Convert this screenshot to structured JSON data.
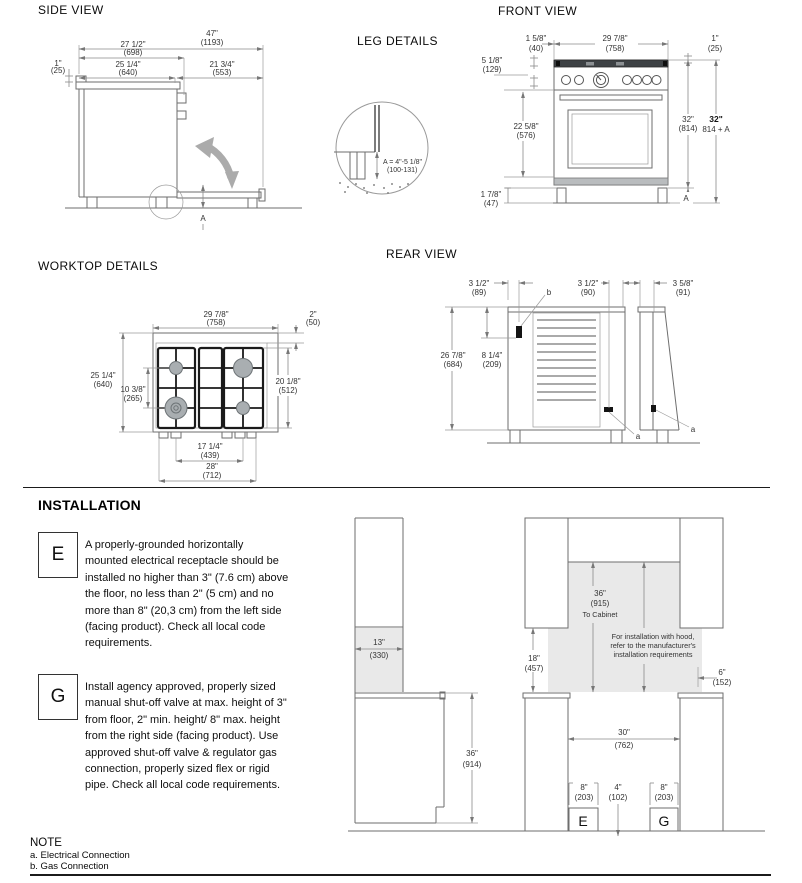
{
  "titles": {
    "side_view": "SIDE VIEW",
    "front_view": "FRONT VIEW",
    "leg_details": "LEG DETAILS",
    "worktop_details": "WORKTOP DETAILS",
    "rear_view": "REAR VIEW",
    "installation": "INSTALLATION"
  },
  "side_view": {
    "dims": {
      "overall_depth_in": "47\"",
      "overall_depth_mm": "(1193)",
      "depth_handle_in": "27 1/2\"",
      "depth_handle_mm": "(698)",
      "top_trim_in": "1\"",
      "top_trim_mm": "(25)",
      "body_depth_in": "25 1/4\"",
      "body_depth_mm": "(640)",
      "door_open_in": "21 3/4\"",
      "door_open_mm": "(553)",
      "leg_label": "A"
    }
  },
  "front_view": {
    "dims": {
      "burner_offset_in": "1 5/8\"",
      "burner_offset_mm": "(40)",
      "width_in": "29 7/8\"",
      "width_mm": "(758)",
      "side_in": "1\"",
      "side_mm": "(25)",
      "panel_in": "5 1/8\"",
      "panel_mm": "(129)",
      "door_in": "22 5/8\"",
      "door_mm": "(576)",
      "height_in": "32\"",
      "height_mm": "(814)",
      "height_total_in": "32\"",
      "height_total_mm": "814 + A",
      "kick_in": "1 7/8\"",
      "kick_mm": "(47)",
      "leg_label": "A"
    }
  },
  "leg_details": {
    "formula_in": "A = 4\"-5 1/8\"",
    "formula_mm": "(100-131)"
  },
  "worktop": {
    "dims": {
      "width_in": "29 7/8\"",
      "width_mm": "(758)",
      "rear_strip_in": "2\"",
      "rear_strip_mm": "(50)",
      "depth_in": "25 1/4\"",
      "depth_mm": "(640)",
      "burner_span_in": "10 3/8\"",
      "burner_span_mm": "(265)",
      "grate_depth_in": "20 1/8\"",
      "grate_depth_mm": "(512)",
      "burner_width_in": "17 1/4\"",
      "burner_width_mm": "(439)",
      "base_width_in": "28\"",
      "base_width_mm": "(712)"
    }
  },
  "rear_view": {
    "dims": {
      "elec_offset_in": "3 1/2\"",
      "elec_offset_mm": "(89)",
      "gas_offset_in": "3 1/2\"",
      "gas_offset_mm": "(90)",
      "panel_in": "3 5/8\"",
      "panel_mm": "(91)",
      "height_in": "26 7/8\"",
      "height_mm": "(684)",
      "elec_height_in": "8 1/4\"",
      "elec_height_mm": "(209)",
      "label_a_main": "a",
      "label_a_side": "a",
      "label_b": "b"
    }
  },
  "installation": {
    "e_key": "E",
    "e_lines": [
      "A properly-grounded horizontally",
      "mounted electrical receptacle should be",
      "installed no higher than 3\" (7.6 cm) above",
      "the floor, no less than 2\" (5 cm) and no",
      "more than 8\" (20,3 cm) from the left side",
      "(facing product). Check all local code",
      "requirements."
    ],
    "g_key": "G",
    "g_lines": [
      "Install agency approved, properly sized",
      "manual shut-off valve at max. height of 3\"",
      "from floor, 2\" min. height/ 8\" max. height",
      "from the right side (facing product). Use",
      "approved shut-off valve & regulator gas",
      "connection, properly sized flex or rigid",
      "pipe. Check all local code requirements."
    ],
    "side_diagram": {
      "clearance_in": "13\"",
      "clearance_mm": "(330)",
      "counter_height_in": "36\"",
      "counter_height_mm": "(914)"
    },
    "front_diagram": {
      "cabinet_in": "36\"",
      "cabinet_mm": "(915)",
      "cabinet_note": "To Cabinet",
      "hood_line1": "For installation with hood,",
      "hood_line2": "refer to the manufacturer's",
      "hood_line3": "installation requirements",
      "backsplash_in": "18\"",
      "backsplash_mm": "(457)",
      "side_in": "6\"",
      "side_mm": "(152)",
      "opening_in": "30\"",
      "opening_mm": "(762)",
      "elec_in": "8\"",
      "elec_mm": "(203)",
      "center_in": "4\"",
      "center_mm": "(102)",
      "gas_in": "8\"",
      "gas_mm": "(203)",
      "label_e": "E",
      "label_g": "G"
    }
  },
  "note": {
    "title": "NOTE",
    "item_a": "a. Electrical Connection",
    "item_b": "b. Gas Connection"
  }
}
